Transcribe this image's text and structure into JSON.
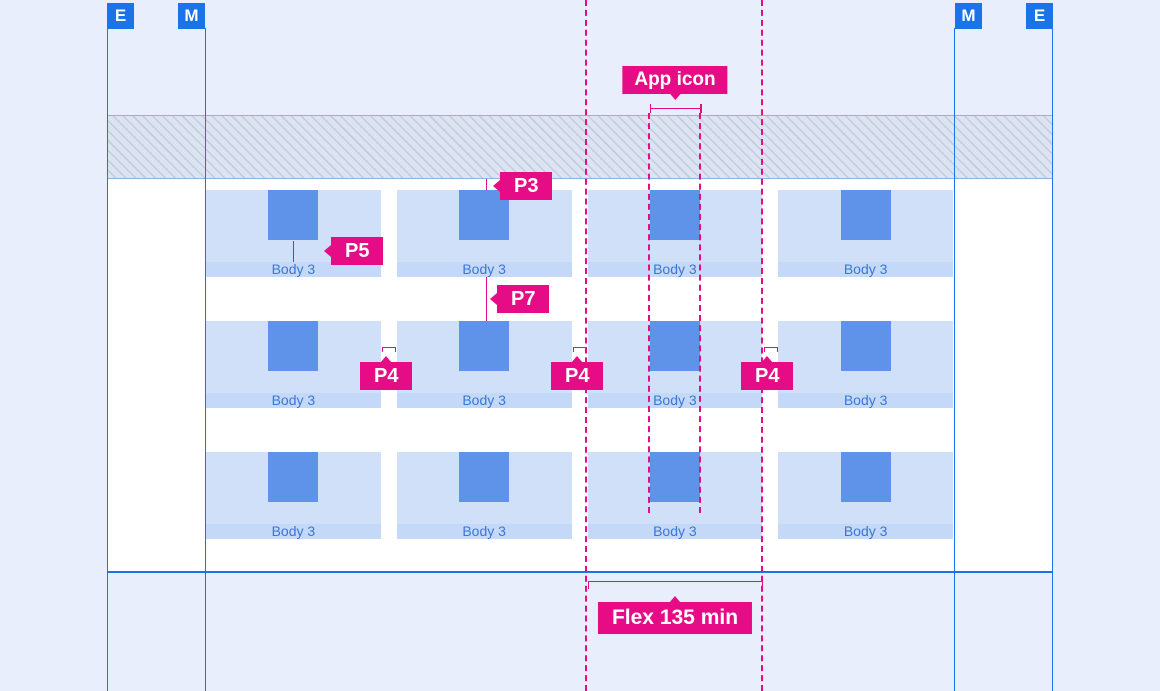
{
  "colors": {
    "accent_blue": "#1a73e8",
    "annotation_pink": "#e60c86",
    "page_background": "#e8eefb",
    "card_background": "#cfe0f8",
    "card_strip": "#c3d9f7",
    "icon_blue": "#5f93ea",
    "card_text_blue": "#3b76d8"
  },
  "margin_markers": [
    {
      "label": "E",
      "position": "left-outer"
    },
    {
      "label": "M",
      "position": "left-inner"
    },
    {
      "label": "M",
      "position": "right-inner"
    },
    {
      "label": "E",
      "position": "right-outer"
    }
  ],
  "annotations": {
    "app_icon": {
      "label": "App icon"
    },
    "p3": {
      "label": "P3"
    },
    "p5": {
      "label": "P5"
    },
    "p7": {
      "label": "P7"
    },
    "p4_left": {
      "label": "P4"
    },
    "p4_middle": {
      "label": "P4"
    },
    "p4_right": {
      "label": "P4"
    },
    "flex_min": {
      "label": "Flex 135 min"
    }
  },
  "grid": {
    "rows": 3,
    "columns": 4,
    "tile_label": "Body 3"
  }
}
